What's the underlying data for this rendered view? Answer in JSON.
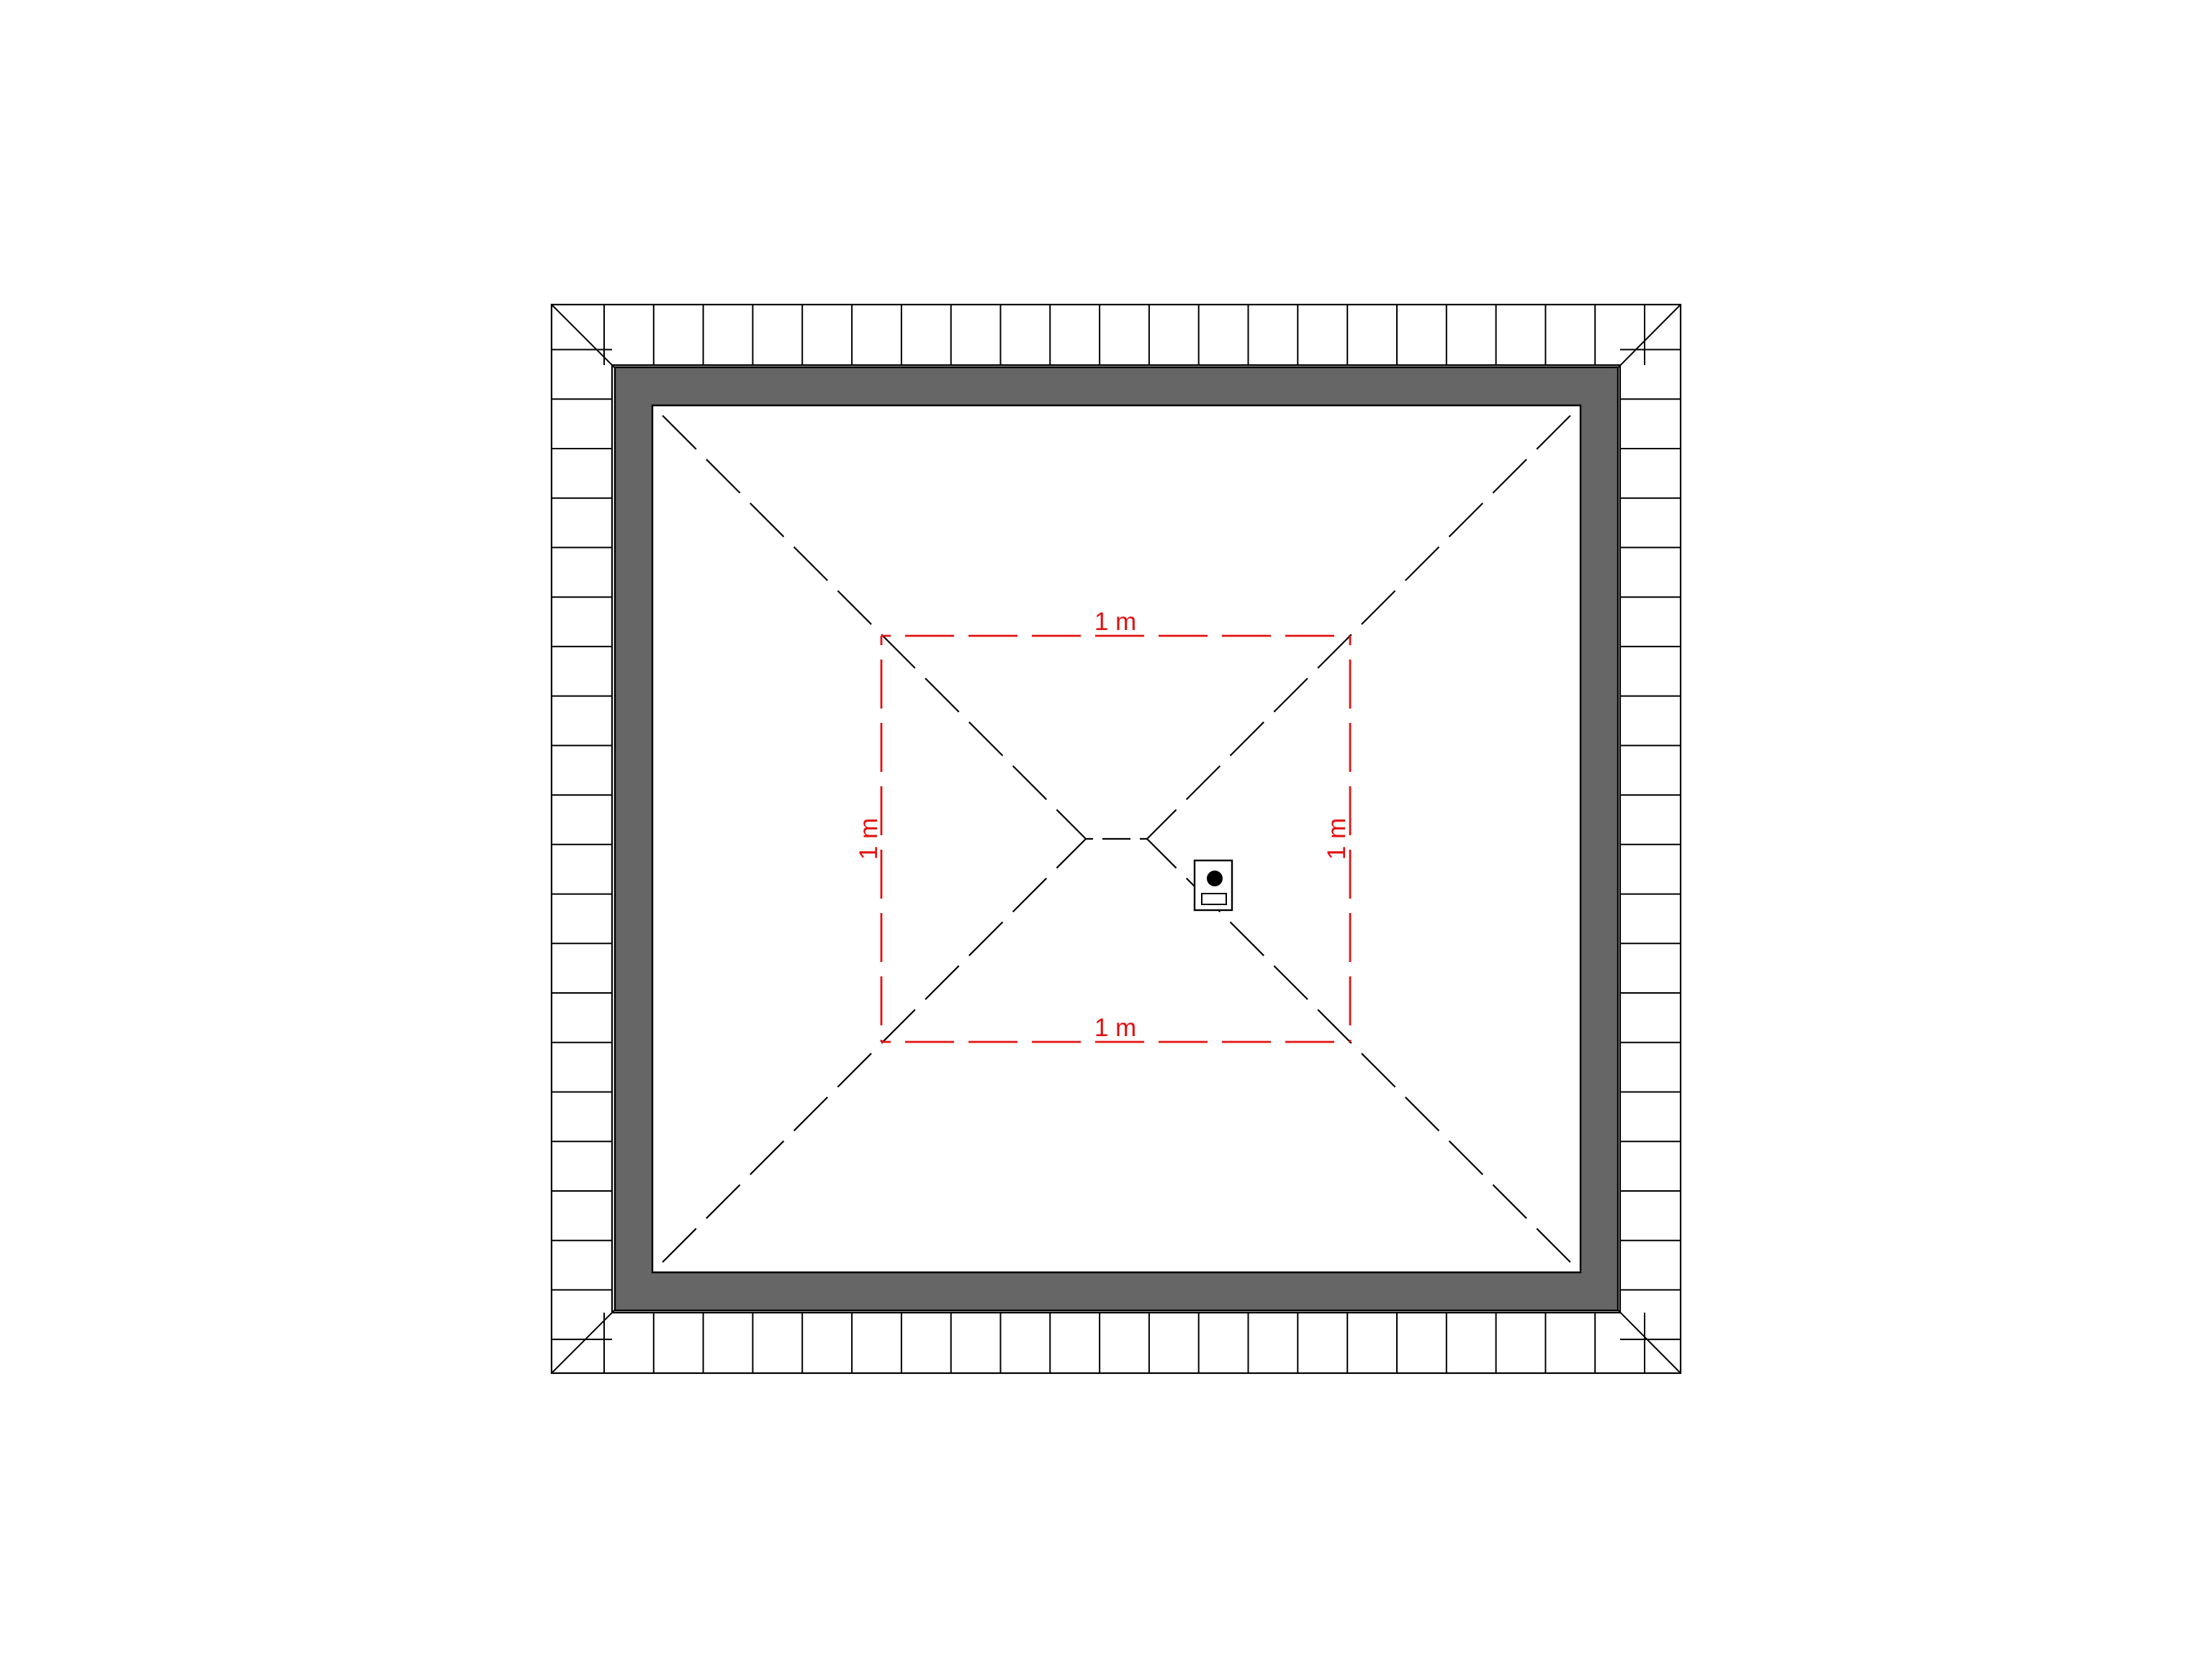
{
  "colors": {
    "dimension-red": "#e31212",
    "fascia-gray": "#666666",
    "line-black": "#000000",
    "background": "#ffffff"
  },
  "drawing": {
    "dimension_labels": {
      "top": "1 m",
      "left": "1 m",
      "right": "1 m",
      "bottom": "1 m"
    }
  }
}
